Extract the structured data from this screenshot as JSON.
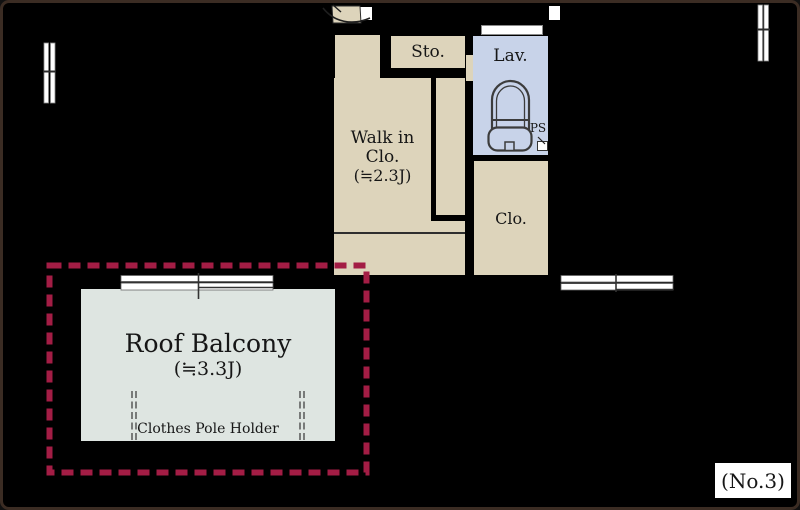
{
  "plan": {
    "number_label": "(No.3)"
  },
  "rooms": {
    "storage": {
      "label": "Sto."
    },
    "walk_in_closet": {
      "line1": "Walk in",
      "line2": "Clo.",
      "size": "(≒2.3J)"
    },
    "lavatory": {
      "label": "Lav."
    },
    "pipe_space": {
      "label": "PS"
    },
    "closet": {
      "label": "Clo."
    },
    "roof_balcony": {
      "title": "Roof Balcony",
      "size": "(≒3.3J)",
      "note": "Clothes Pole Holder"
    }
  },
  "colors": {
    "background": "#000000",
    "frame_brown": "#3b2c23",
    "room_beige": "#ddd4bb",
    "lavatory_blue": "#c8d3e9",
    "balcony_gray": "#dee5e1",
    "boundary_crimson": "#a31d45",
    "window_white": "#ffffff",
    "text": "#161616"
  }
}
